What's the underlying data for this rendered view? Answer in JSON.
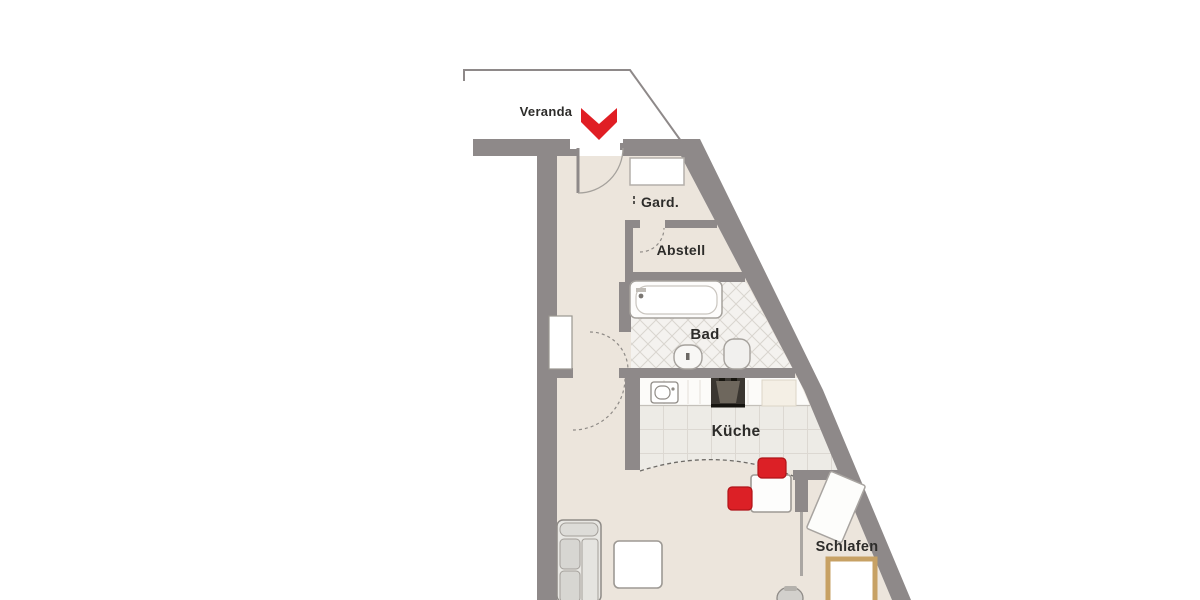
{
  "floor_plan": {
    "rooms": {
      "veranda": {
        "label": "Veranda"
      },
      "garderobe": {
        "label": "Gard."
      },
      "abstellraum": {
        "label": "Abstell"
      },
      "bad": {
        "label": "Bad"
      },
      "kueche": {
        "label": "Küche"
      },
      "schlafzimmer": {
        "label": "Schlafen"
      }
    },
    "entrance_marker": {
      "icon": "double-chevron-down",
      "color": "#e01e24"
    },
    "colors": {
      "walls": "#8e8989",
      "floor_beige": "#ece5dc",
      "bathroom_tile": "#f4f2ef",
      "kitchen_tile": "#edebe6",
      "accent_red": "#dc2026",
      "bed_frame_tan": "#c7a164"
    },
    "symbols": [
      "entrance-chevron-icon",
      "entry-door",
      "door-swing-arc",
      "window",
      "wardrobe",
      "bathtub",
      "washbasin",
      "toilet",
      "kitchen-counter",
      "kitchen-sink",
      "stove",
      "kitchen-cabinet",
      "dining-table",
      "dining-chair",
      "sofa",
      "coffee-table",
      "bed",
      "bedroom-wardrobe",
      "desk-chair",
      "sliding-door"
    ]
  }
}
